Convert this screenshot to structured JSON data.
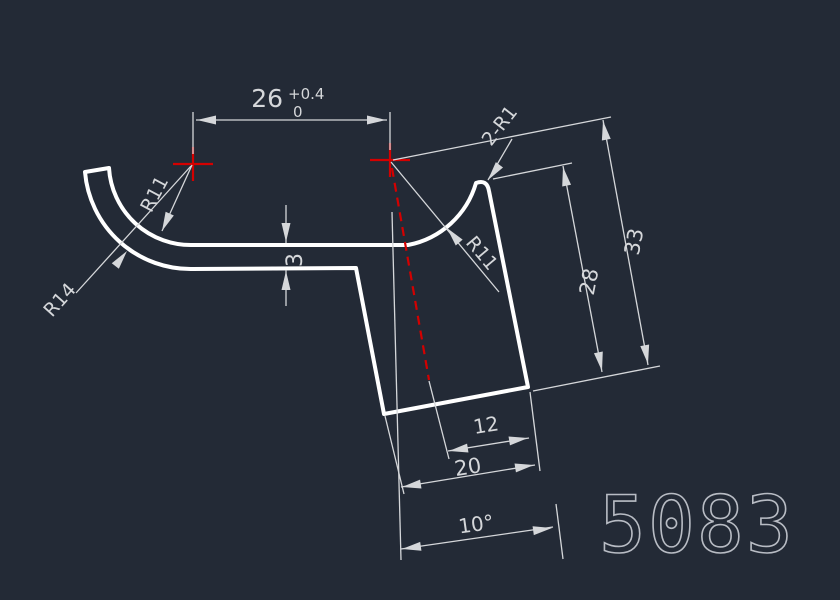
{
  "drawing": {
    "part_number": "5083",
    "labels": {
      "dim_26": "26",
      "dim_26_tol_upper": "+0.4",
      "dim_26_tol_lower": "0",
      "dim_thickness": "3",
      "radius_outer_left": "R14",
      "radius_inner_left": "R11",
      "radius_bend_right": "R11",
      "corner_radii": "2-R1",
      "dim_flange_height": "28",
      "dim_total_height": "33",
      "dim_12": "12",
      "dim_20": "20",
      "dim_angle": "10°"
    },
    "colors": {
      "background": "#232a36",
      "profile_line": "#ffffff",
      "dimension_line": "#d5d7da",
      "centerline_red": "#d40000",
      "part_number_text": "#b8bcc4"
    }
  }
}
